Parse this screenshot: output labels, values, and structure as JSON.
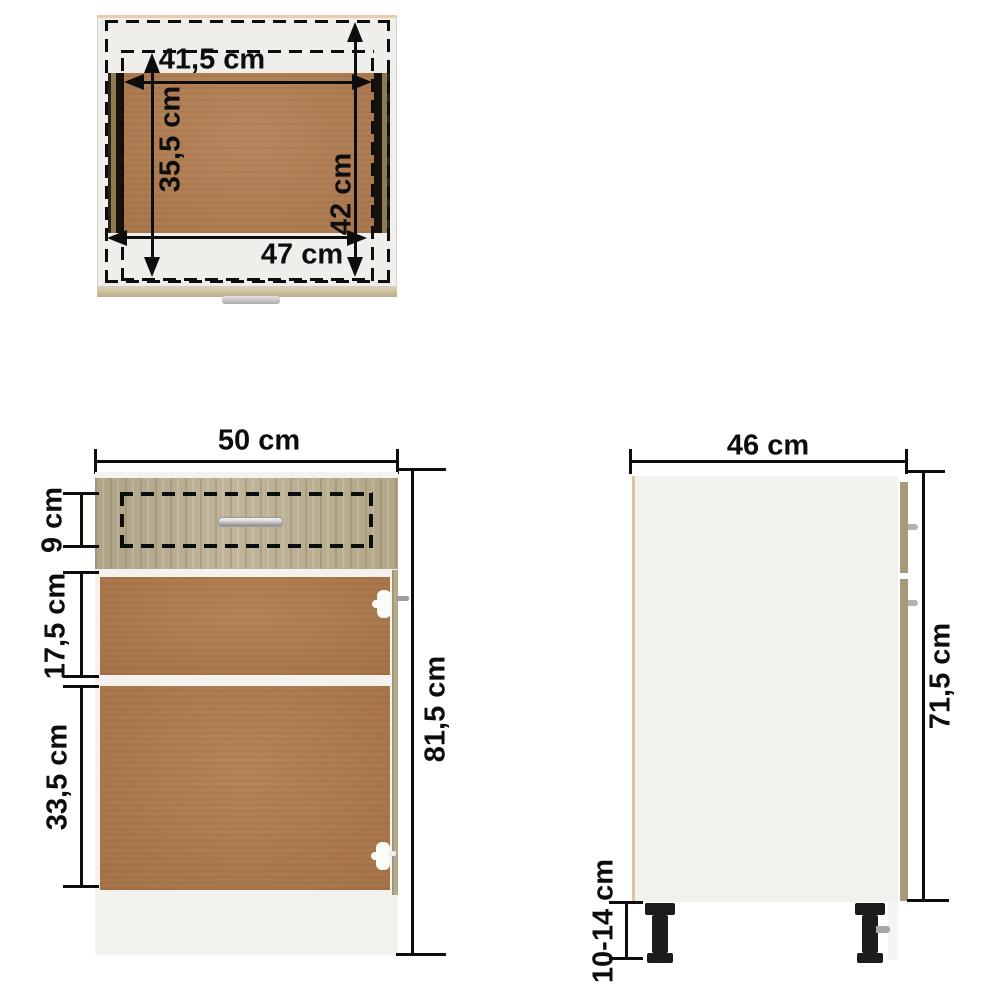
{
  "diagram": {
    "subject": "kitchen-bottom-cabinet-with-drawer-dimension-drawing",
    "unit": "cm",
    "top_view": {
      "inner_width_label": "41,5 cm",
      "inner_depth_label": "35,5 cm",
      "drawer_depth_label": "42 cm",
      "drawer_width_label": "47 cm"
    },
    "front_view": {
      "width_label": "50 cm",
      "drawer_front_height_label": "9 cm",
      "upper_compartment_label": "17,5 cm",
      "lower_compartment_label": "33,5 cm",
      "total_height_label": "81,5 cm"
    },
    "side_view": {
      "depth_label": "46 cm",
      "body_height_label": "71,5 cm",
      "leg_height_label": "10-14 cm"
    },
    "colors": {
      "dimension_line": "#0d0d0d",
      "mdf_brown": "#b07a4b",
      "sonoma_oak": "#bcb091",
      "panel_white": "#f3f1ee",
      "edge_tan": "#a89a77",
      "leg_black": "#1c1c1c"
    }
  }
}
